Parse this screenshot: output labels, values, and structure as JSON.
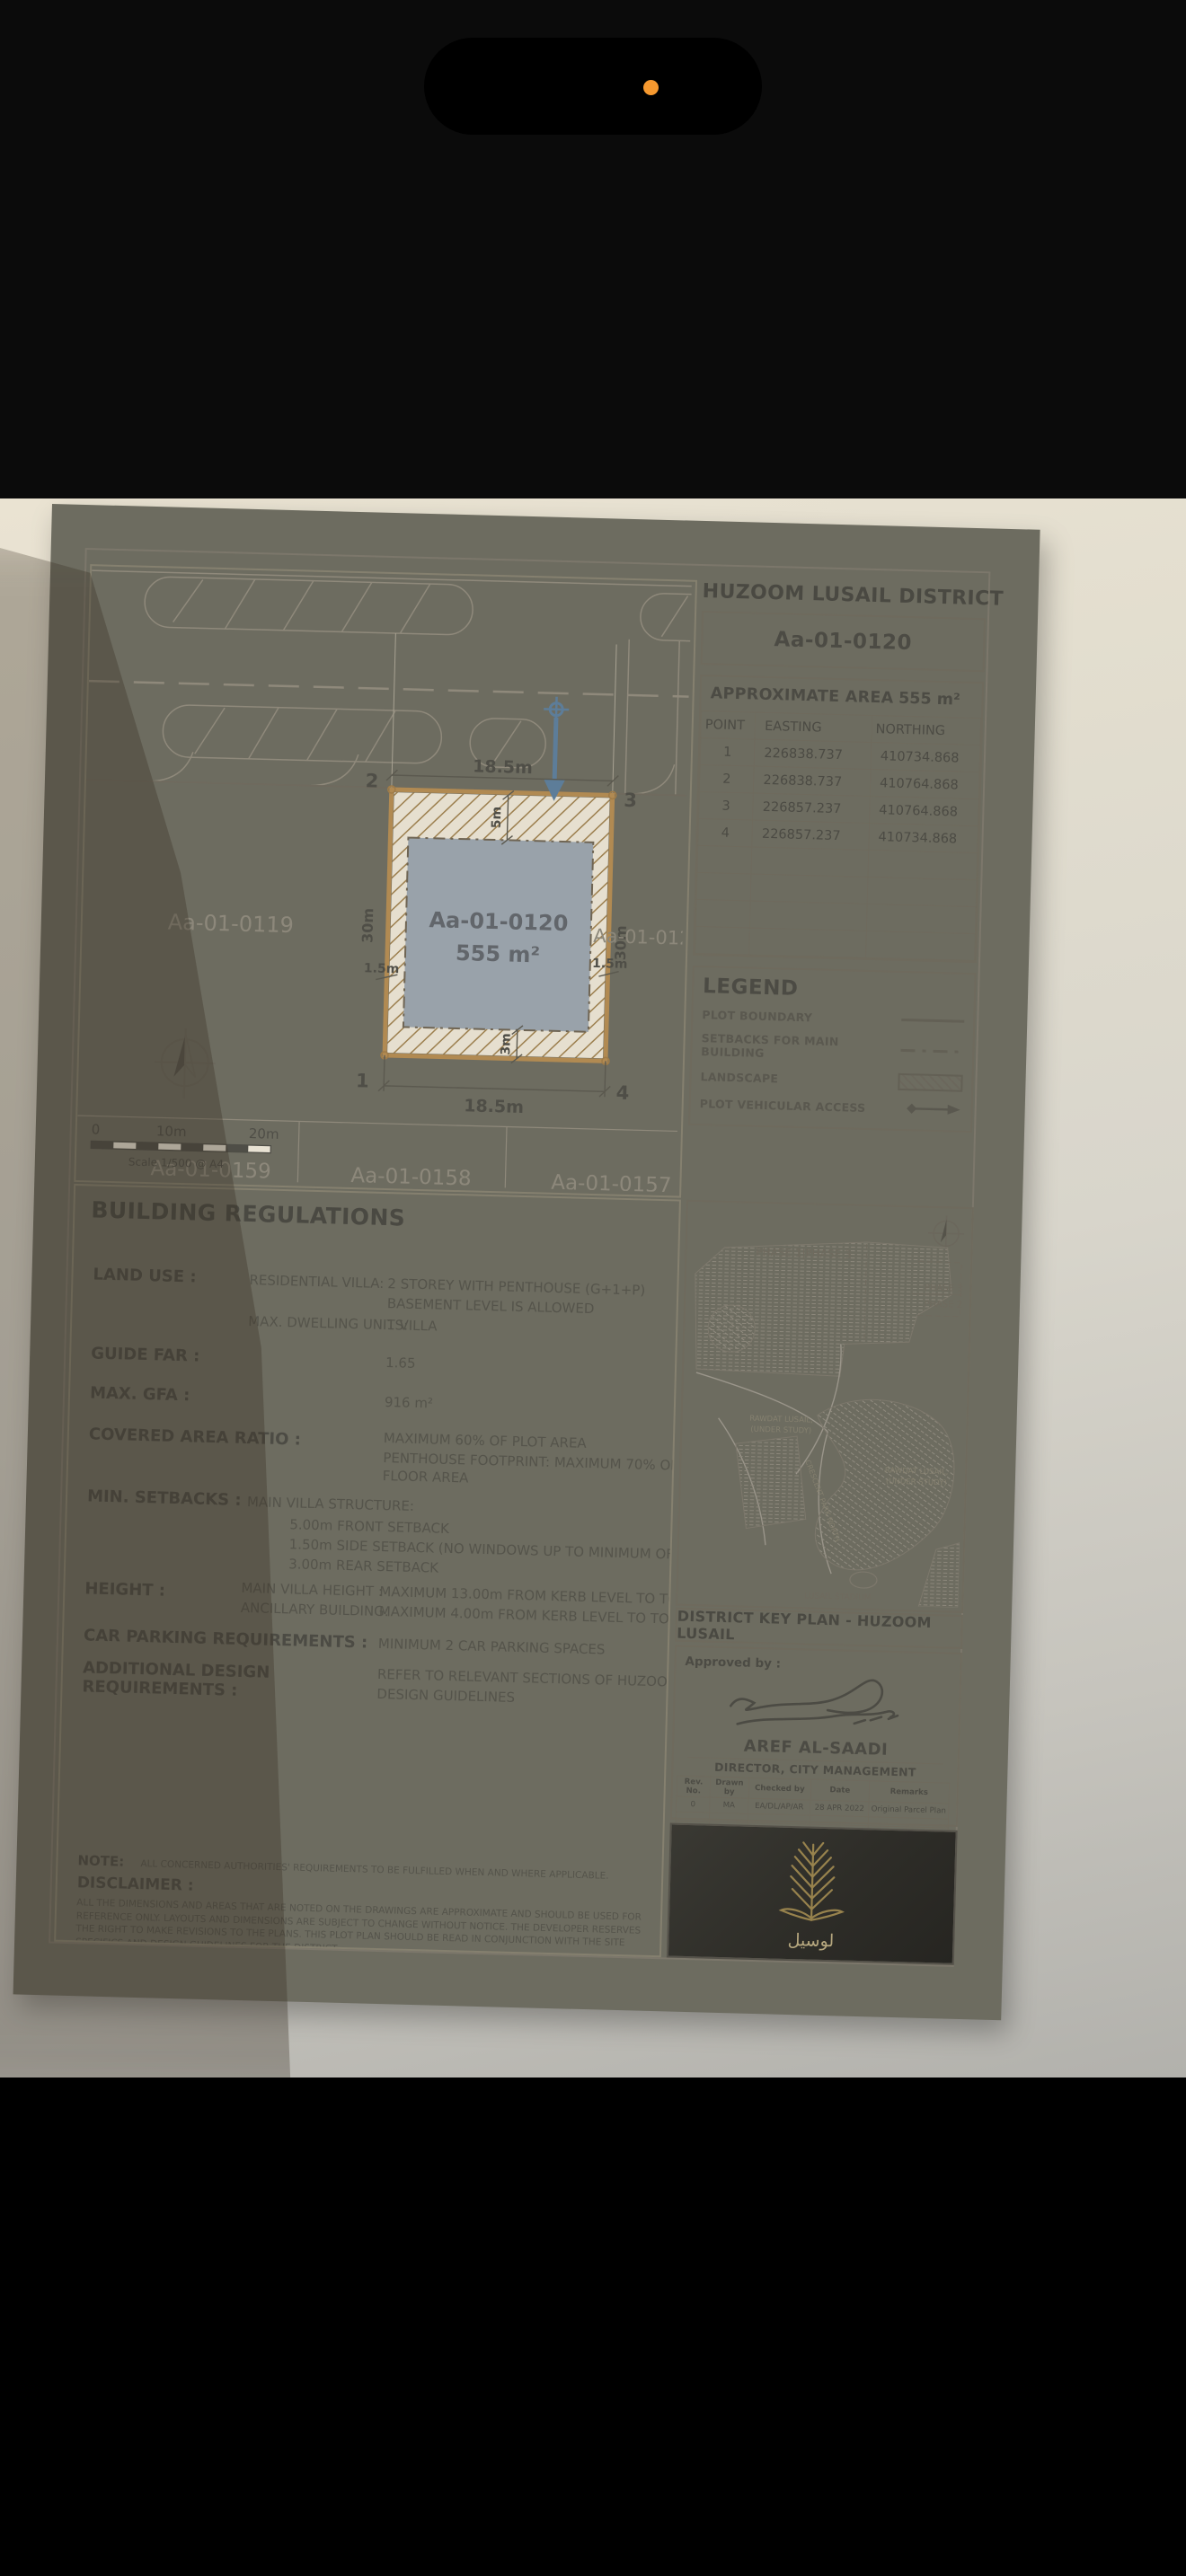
{
  "phone": {
    "camera_indicator_color": "#f6992f"
  },
  "colors": {
    "paper": "#e9e3d4",
    "sheet_frame": "#6d6c60",
    "plot_boundary": "#b18a52",
    "building_footprint": "#99a2aa",
    "access_arrow": "#5d7d99",
    "logo_gold": "#97824d"
  },
  "header": {
    "district_title": "HUZOOM LUSAIL DISTRICT",
    "plot_id": "Aa-01-0120"
  },
  "area_table": {
    "title": "APPROXIMATE AREA",
    "area_value": "555 m²",
    "col_point": "POINT",
    "col_easting": "EASTING",
    "col_northing": "NORTHING",
    "rows": [
      [
        "1",
        "226838.737",
        "410734.868"
      ],
      [
        "2",
        "226838.737",
        "410764.868"
      ],
      [
        "3",
        "226857.237",
        "410764.868"
      ],
      [
        "4",
        "226857.237",
        "410734.868"
      ]
    ]
  },
  "legend": {
    "title": "LEGEND",
    "plot_boundary": "PLOT BOUNDARY",
    "setbacks": "SETBACKS FOR MAIN BUILDING",
    "landscape": "LANDSCAPE",
    "vehicular_access": "PLOT VEHICULAR ACCESS"
  },
  "site_plan": {
    "plots": {
      "left": "Aa-01-0119",
      "center_id": "Aa-01-0120",
      "center_area": "555 m²",
      "right": "Aa-01-0121",
      "bottom_left": "Aa-01-0159",
      "bottom_center": "Aa-01-0158",
      "bottom_right": "Aa-01-0157"
    },
    "dims": {
      "width_top": "18.5m",
      "width_bottom": "18.5m",
      "depth_left": "30m",
      "depth_right": "30m",
      "front": "5m",
      "rear": "3m",
      "side_left": "1.5m",
      "side_right": "1.5m"
    },
    "corners": {
      "c1": "1",
      "c2": "2",
      "c3": "3",
      "c4": "4"
    },
    "scale": {
      "t0": "0",
      "t10": "10m",
      "t20": "20m",
      "note": "Scale 1/500 @ A4"
    }
  },
  "regulations": {
    "title": "BUILDING REGULATIONS",
    "land_use_label": "LAND USE :",
    "land_use_sub": "RESIDENTIAL VILLA:",
    "land_use_v1": "2 STOREY WITH PENTHOUSE  (G+1+P)",
    "land_use_v2": "BASEMENT LEVEL IS ALLOWED",
    "dwelling_label": "MAX. DWELLING UNITS:",
    "dwelling_val": "1 VILLA",
    "far_label": "GUIDE FAR :",
    "far_val": "1.65",
    "gfa_label": "MAX. GFA :",
    "gfa_val": "916 m²",
    "car_ratio_label": "COVERED AREA RATIO :",
    "car_ratio_v1": "MAXIMUM 60% OF PLOT AREA",
    "car_ratio_v2": "PENTHOUSE FOOTPRINT: MAXIMUM 70% OF FIRST",
    "car_ratio_v3": "FLOOR AREA",
    "setbacks_label": "MIN. SETBACKS :",
    "setbacks_sub": "MAIN VILLA STRUCTURE:",
    "setbacks_v1": "5.00m FRONT SETBACK",
    "setbacks_v2": "1.50m SIDE SETBACK (NO WINDOWS UP TO MINIMUM OF 3 METERS)",
    "setbacks_v3": "3.00m REAR SETBACK",
    "height_label": "HEIGHT :",
    "height_sub1": "MAIN VILLA HEIGHT :",
    "height_v1": "MAXIMUM 13.00m FROM KERB LEVEL TO TOP PARAPET",
    "height_sub2": "ANCILLARY BUILDING:",
    "height_v2": "MAXIMUM 4.00m FROM KERB LEVEL TO TOP PARAPET",
    "parking_label": "CAR PARKING REQUIREMENTS :",
    "parking_val": "MINIMUM 2 CAR PARKING SPACES",
    "additional_label1": "ADDITIONAL DESIGN",
    "additional_label2": "REQUIREMENTS :",
    "additional_v1": "REFER TO RELEVANT SECTIONS OF HUZOOM LUSAIL",
    "additional_v2": "DESIGN GUIDELINES"
  },
  "note": {
    "label": "NOTE:",
    "text": "ALL CONCERNED AUTHORITIES' REQUIREMENTS TO BE FULFILLED WHEN AND WHERE APPLICABLE."
  },
  "disclaimer": {
    "label": "DISCLAIMER :",
    "text": "ALL THE DIMENSIONS AND AREAS THAT ARE NOTED ON THE DRAWINGS ARE  APPROXIMATE AND SHOULD BE USED FOR REFERENCE ONLY.  LAYOUTS AND DIMENSIONS ARE SUBJECT TO CHANGE WITHOUT NOTICE. THE DEVELOPER RESERVES THE RIGHT TO MAKE REVISIONS TO  THE PLANS. THIS PLOT PLAN SHOULD BE READ IN CONJUNCTION WITH THE SITE SPECIFICS AND DESIGN GUIDELINES FOR THE DISTRICT."
  },
  "key_plan": {
    "title": "DISTRICT KEY PLAN - HUZOOM LUSAIL",
    "labels": {
      "phase_top": "PHASE 1|PHASE 3",
      "phase_right_top": "PHASE 3",
      "phase_right_bottom": "PHASE 2",
      "area1_l1": "RAWDAT LUSAIL,",
      "area1_l2": "(UNDER STUDY)",
      "area2_l1": "RAWDAT LUSAIL,",
      "area2_l2": "(UNDER STUDY)",
      "road": "CRESCENT PARK NORTH",
      "stadium": "LUSAIL STADIUM"
    }
  },
  "approval": {
    "label": "Approved by :",
    "name": "AREF AL-SAADI",
    "title": "DIRECTOR, CITY MANAGEMENT"
  },
  "revision_table": {
    "h_rev": "Rev. No.",
    "h_drawn": "Drawn by",
    "h_checked": "Checked by",
    "h_date": "Date",
    "h_remarks": "Remarks",
    "rev": "0",
    "drawn": "MA",
    "checked": "EA/DL/AP/AR",
    "date": "28 APR 2022",
    "remarks": "Original Parcel Plan"
  },
  "logo": {
    "arabic": "لوسيل"
  }
}
